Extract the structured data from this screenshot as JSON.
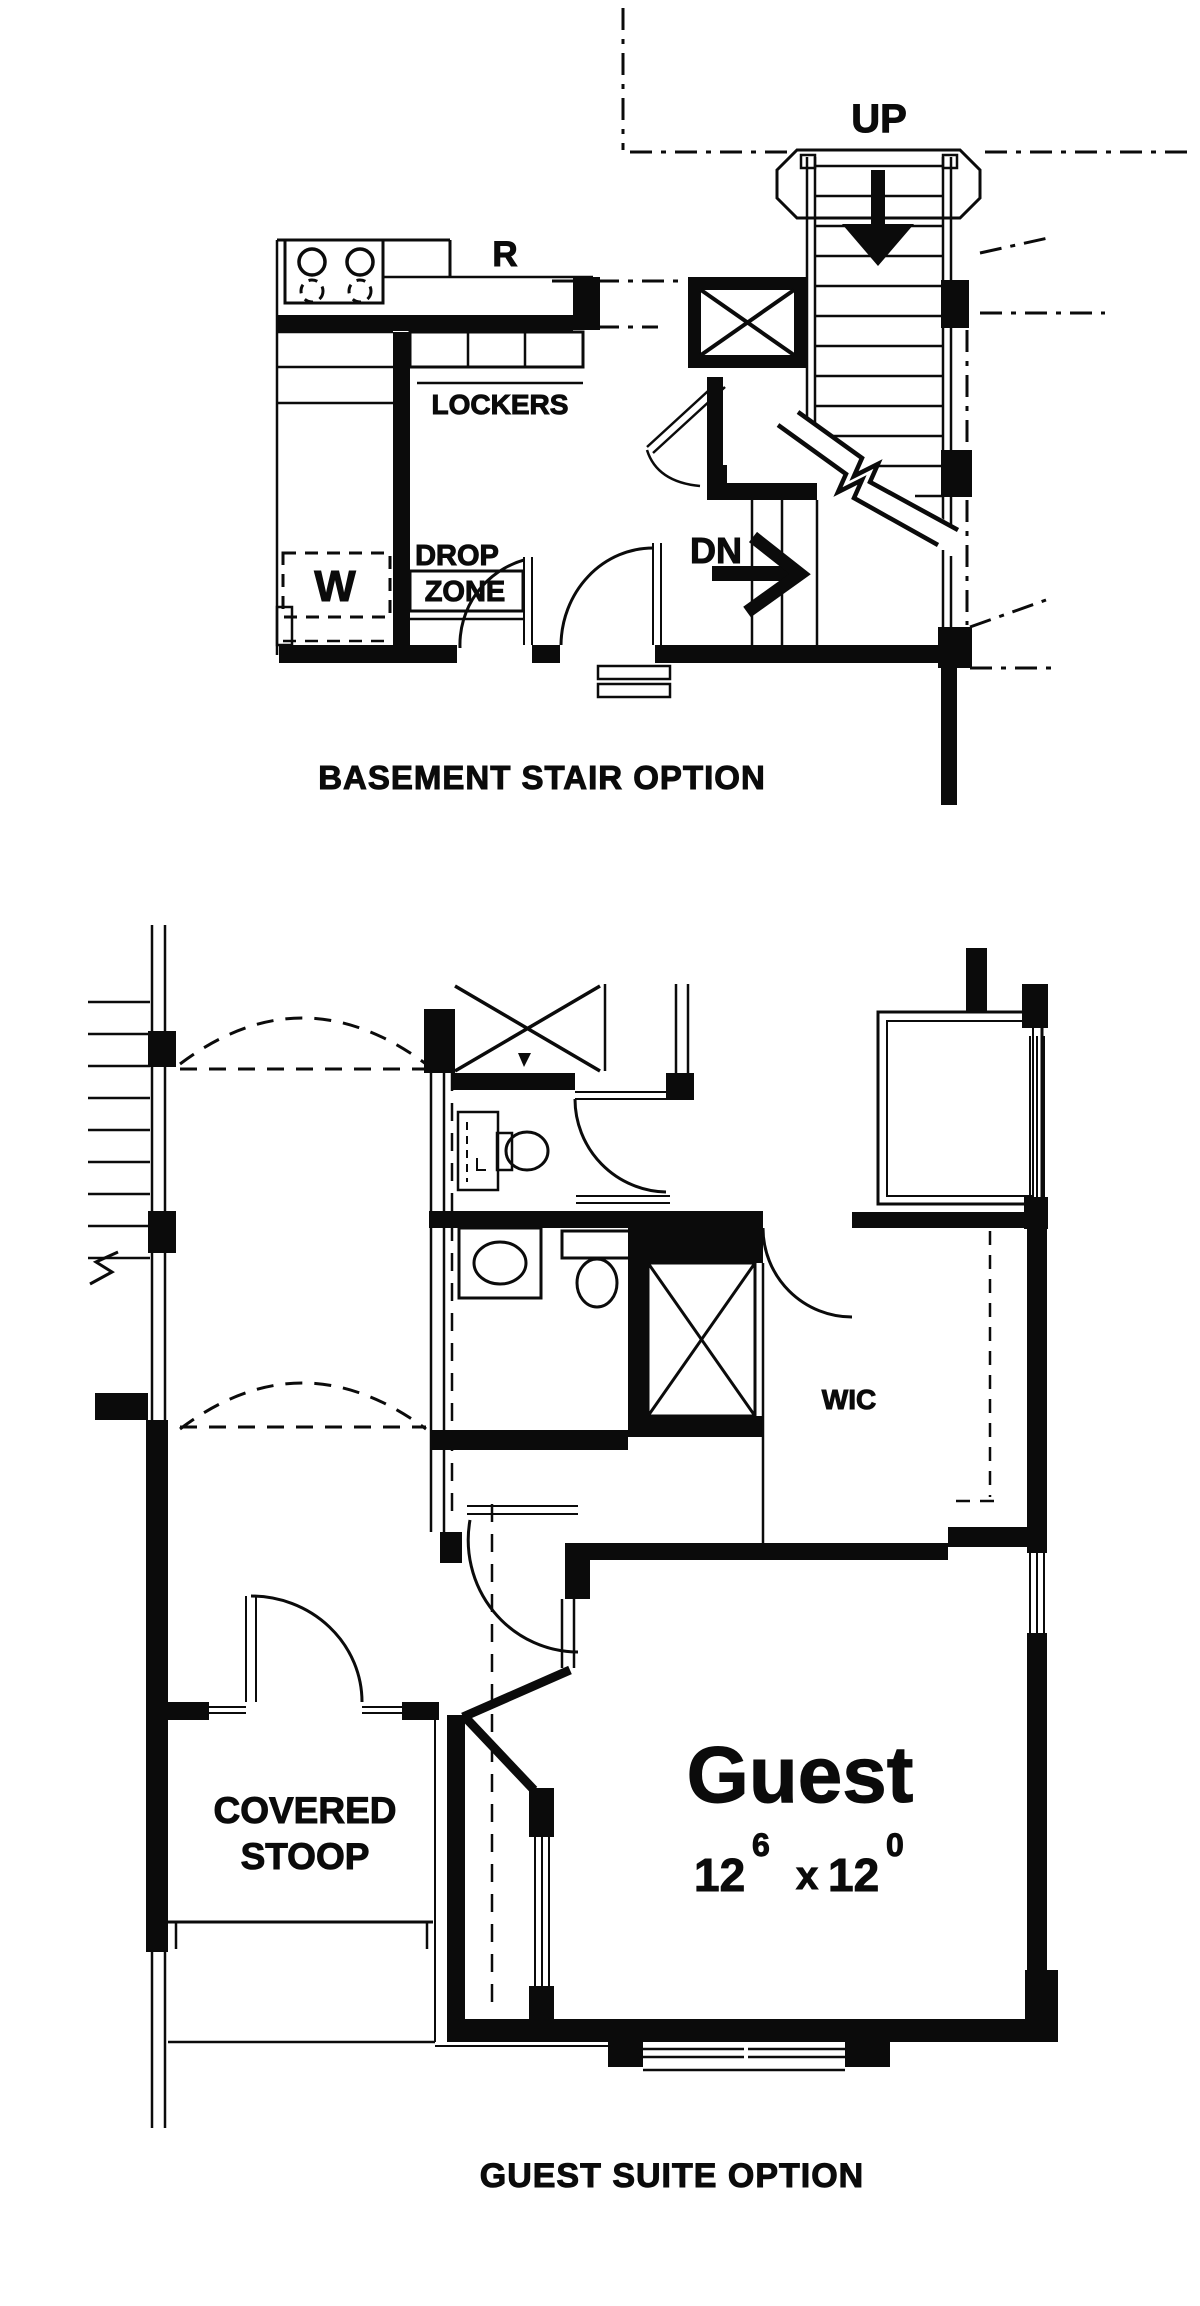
{
  "document": {
    "type": "floor-plan-sheet",
    "background": "#ffffff",
    "ink": "#0b0b0b"
  },
  "plans": [
    {
      "name": "basement-stair-option",
      "caption": "BASEMENT STAIR OPTION",
      "labels": {
        "up": "UP",
        "down": "DN",
        "range": "R",
        "lockers": "LOCKERS",
        "washer": "W",
        "drop_zone_line1": "DROP",
        "drop_zone_line2": "ZONE"
      }
    },
    {
      "name": "guest-suite-option",
      "caption": "GUEST SUITE OPTION",
      "labels": {
        "closet": "WIC",
        "room": "Guest",
        "covered_line1": "COVERED",
        "covered_line2": "STOOP"
      },
      "dimensions": {
        "width_ft": "12",
        "width_in": "6",
        "separator": "x",
        "depth_ft": "12",
        "depth_in": "0"
      }
    }
  ]
}
